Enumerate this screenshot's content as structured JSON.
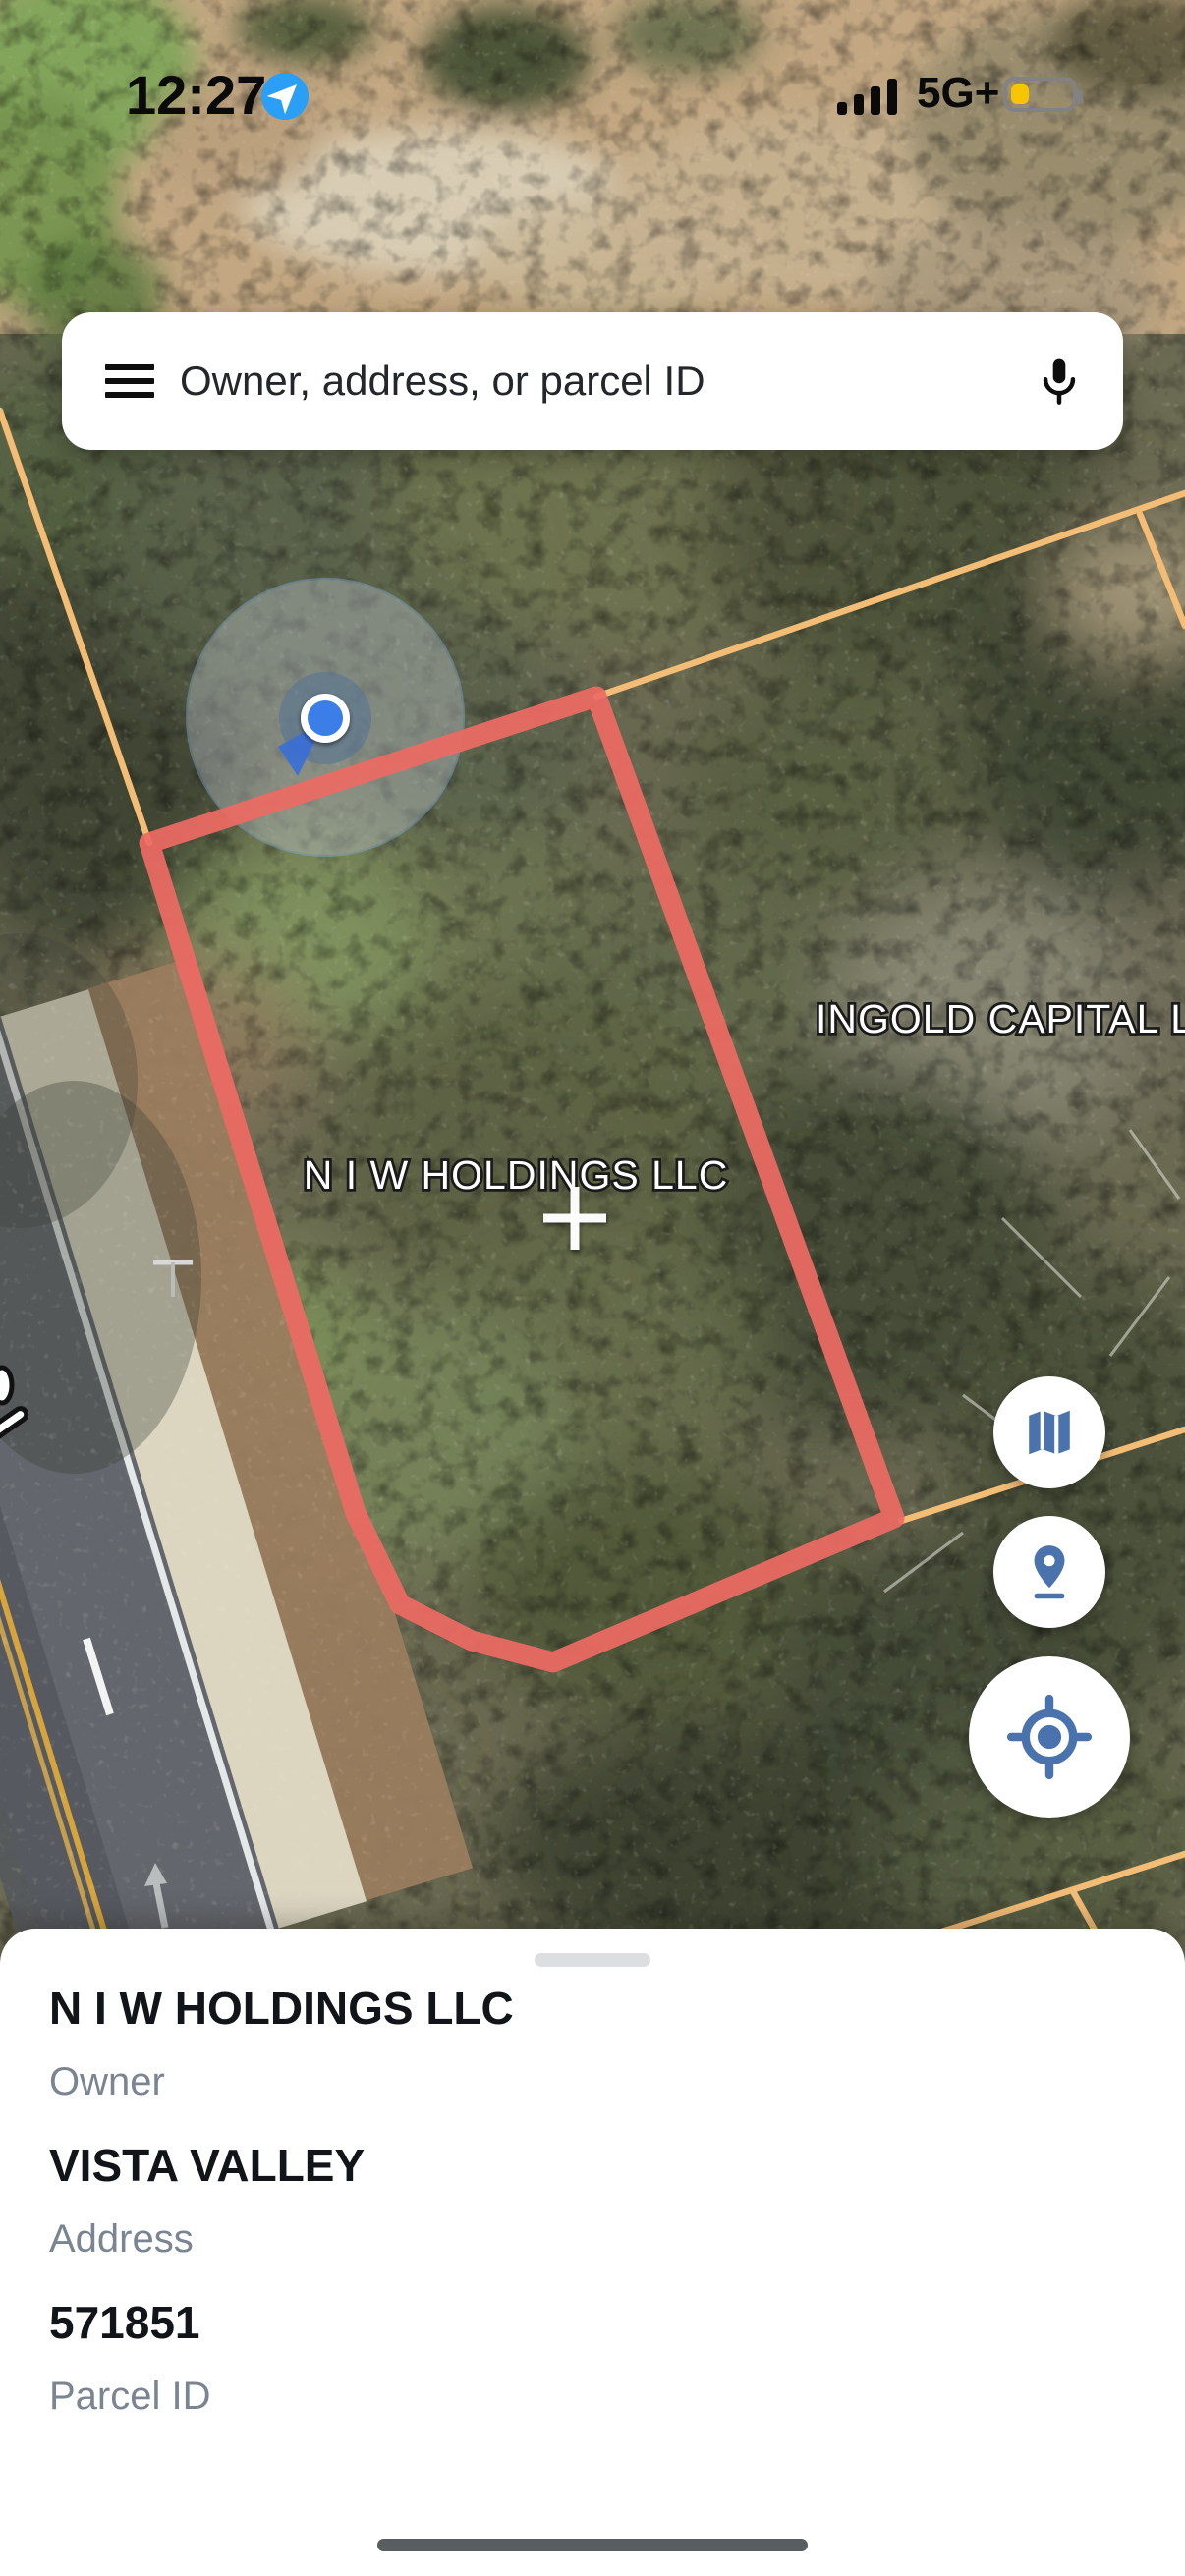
{
  "status_bar": {
    "time": "12:27",
    "network": "5G+"
  },
  "search_bar": {
    "placeholder": "Owner, address, or parcel ID"
  },
  "map": {
    "selected_parcel_label": "N I W HOLDINGS LLC",
    "adjacent_parcel_label": "INGOLD CAPITAL L",
    "icons": {
      "menu": "hamburger-menu-icon",
      "mic": "microphone-icon",
      "controls": [
        "map-layers-icon",
        "parcel-pin-icon",
        "my-location-icon"
      ]
    },
    "colors": {
      "selected_parcel_outline": "#ec6a63",
      "parcel_boundary_line": "#f4bd76",
      "control_icon_blue": "#4a73ad",
      "location_dot_blue": "#3b7ee8"
    }
  },
  "bottom_sheet": {
    "fields": [
      {
        "value": "N I W HOLDINGS LLC",
        "label": "Owner"
      },
      {
        "value": "VISTA VALLEY",
        "label": "Address"
      },
      {
        "value": "571851",
        "label": "Parcel ID"
      }
    ]
  }
}
